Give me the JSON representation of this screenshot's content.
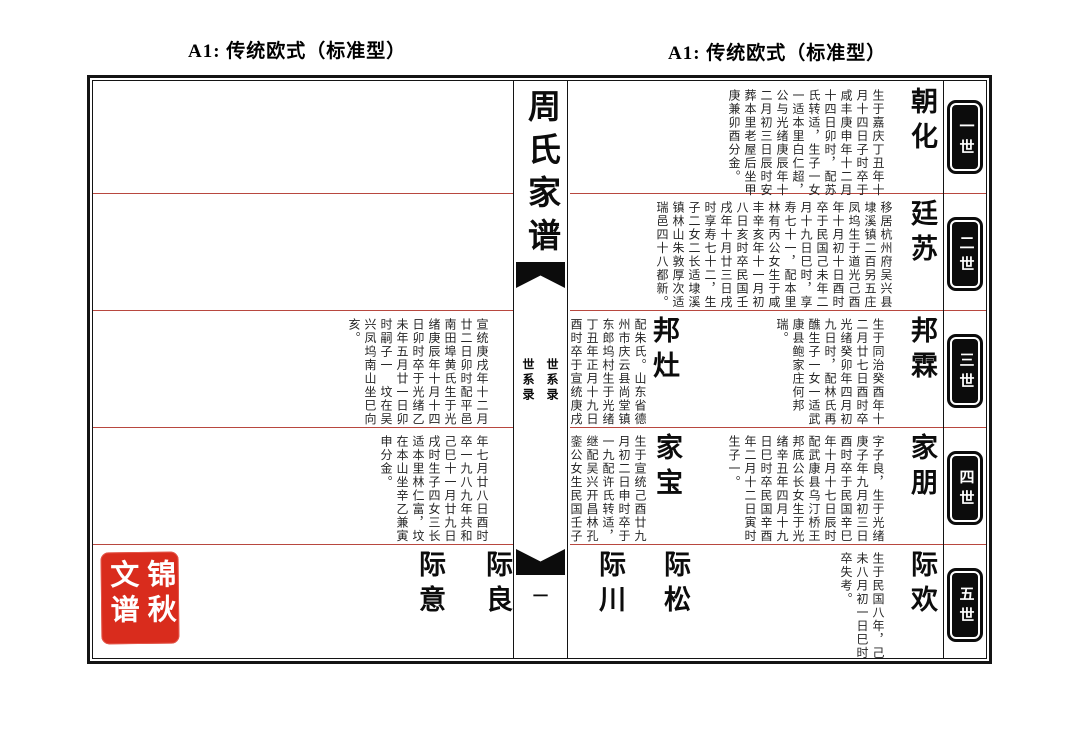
{
  "headers": {
    "left": "A1: 传统欧式（标准型）",
    "right": "A1: 传统欧式（标准型）"
  },
  "spine": {
    "title": "周氏家谱",
    "volume_label": "世系录",
    "page_number": "一"
  },
  "generations": {
    "g1": "一世",
    "g2": "二世",
    "g3": "三世",
    "g4": "四世",
    "g5": "五世"
  },
  "right_page": {
    "gen1": {
      "name": "朝化",
      "text": "生于嘉庆丁丑年十月十四日子时卒于咸丰庚申年十二月十四日卯时，配苏氏转适，生子一女一适本里白仁超，公与光绪庚辰年十二月初三日辰时安葬本里老屋后坐甲庚兼卯酉分金。"
    },
    "gen2": {
      "name": "廷苏",
      "text": "移居杭州府吴兴县埭溪镇二百另五庄凤坞生于道光己酉年十月初十日酉时卒于民国己未年二月十九日巳时，享寿七十一，配本里林有丙公女生于咸丰辛亥年十一月初八日亥时卒民国壬戌年十月廿三日戌时享寿七十二，生子二女二长适埭溪镇林山朱敦厚次适瑞邑四十八都新。"
    },
    "gen3a": {
      "name": "邦霖",
      "text": "生于同治癸酉年十二月廿七日酉时卒光绪癸卯年四月初九日时，配林氏再醮生子一女一适武康县鲍家庄何邦瑞。"
    },
    "gen3b": {
      "name": "邦灶",
      "text": "配朱氏。山东省德州市庆云县尚堂镇东郎坞村生于光绪丁丑年正月十九日酉时卒于宣统庚戌"
    },
    "gen4a": {
      "name": "家朋",
      "text": "字子良，生于光绪庚子年九月初三日酉时卒于民国辛巳年十月十七日辰时配武康县乌汀桥王邦底公长女生于光绪辛丑年四月十九日巳时卒民国辛酉年二月十二日寅时生子一。"
    },
    "gen4b": {
      "name": "家宝",
      "text": "生于宣统己酉廿九月初二日申时卒于一九配许氏转适，继配吴兴开昌林孔銮公女生民国壬子"
    },
    "gen5a": {
      "name": "际欢",
      "text": "生于民国八年，己未八月初一日巳时卒失考。"
    },
    "gen5b": {
      "name": "际松"
    },
    "gen5c": {
      "name": "际川"
    }
  },
  "left_page": {
    "gen3_cont": {
      "text": "宣统庚戌年十二月廿二日卯时配平邑南田埠黄氏生于光绪庚辰年十月十四日卯时卒于光绪乙未年五月廿一日卯时嗣子一　坟在吴兴凤坞南山坐巳向亥。"
    },
    "gen4_cont": {
      "text": "年七月廿八日酉时卒一九八九年共和己巳十一月廿九日戌时生子四女三长适本里林仁富，坟在本山坐辛乙兼寅申分金。"
    },
    "gen5a": {
      "name": "际良"
    },
    "gen5b": {
      "name": "际意"
    }
  },
  "seal": {
    "text": "锦秋文谱"
  },
  "colors": {
    "row_line_red": "#b8483f",
    "seal_red": "#d92c1d",
    "ink": "#0c0c0c"
  }
}
